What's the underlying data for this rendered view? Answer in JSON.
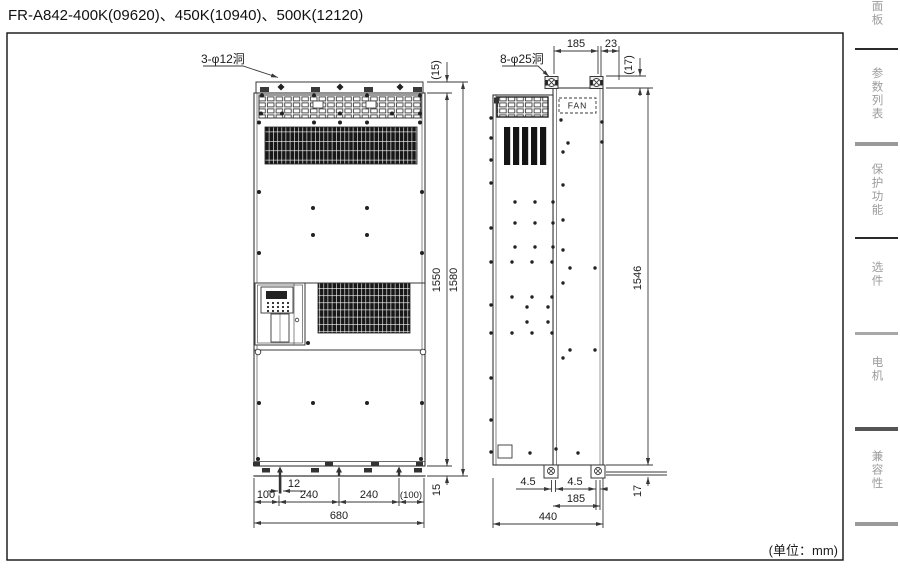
{
  "page": {
    "title": "FR-A842-400K(09620)、450K(10940)、500K(12120)",
    "unit_note": "(单位：mm)"
  },
  "front": {
    "hole_label": "3-φ12洞",
    "dim_top_offset": "(15)",
    "dim_height_inner": "1550",
    "dim_height_total": "1580",
    "dim_bottom_offset": "15",
    "dim_slot": "12",
    "chain": [
      "100",
      "240",
      "240",
      "(100)"
    ],
    "dim_width": "680"
  },
  "side": {
    "hole_label": "8-φ25洞",
    "fan_label": "FAN",
    "dim_top_pitch": "185",
    "dim_top_rear": "23",
    "dim_lug": "(17)",
    "dim_height": "1546",
    "dim_foot_left": "4.5",
    "dim_foot_right": "4.5",
    "dim_foot_pitch": "185",
    "dim_depth": "440",
    "dim_foot_height": "17"
  },
  "tabs": [
    {
      "label": "操作面板"
    },
    {
      "label": "参数列表"
    },
    {
      "label": "保护功能"
    },
    {
      "label": "选件"
    },
    {
      "label": "电机"
    },
    {
      "label": "兼容性"
    }
  ]
}
